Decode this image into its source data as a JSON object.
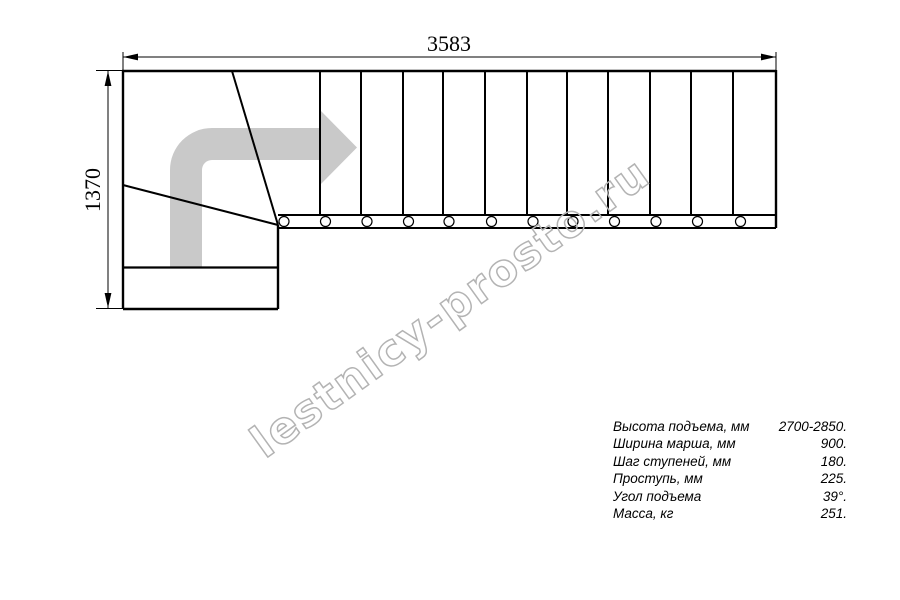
{
  "drawing": {
    "width_dim": "3583",
    "height_dim": "1370",
    "watermark": "lestnicy-prosto.ru",
    "straight_steps": 12,
    "colors": {
      "line": "#000000",
      "arrow_fill": "#c9c9c9",
      "watermark_stroke": "#b3b3b3"
    }
  },
  "specs": {
    "rows": [
      {
        "label": "Высота подъема, мм",
        "value": "2700-2850."
      },
      {
        "label": "Ширина марша, мм",
        "value": "900."
      },
      {
        "label": "Шаг ступеней, мм",
        "value": "180."
      },
      {
        "label": "Проступь, мм",
        "value": "225."
      },
      {
        "label": "Угол подъема",
        "value": "39°."
      },
      {
        "label": "Масса, кг",
        "value": "251."
      }
    ]
  }
}
